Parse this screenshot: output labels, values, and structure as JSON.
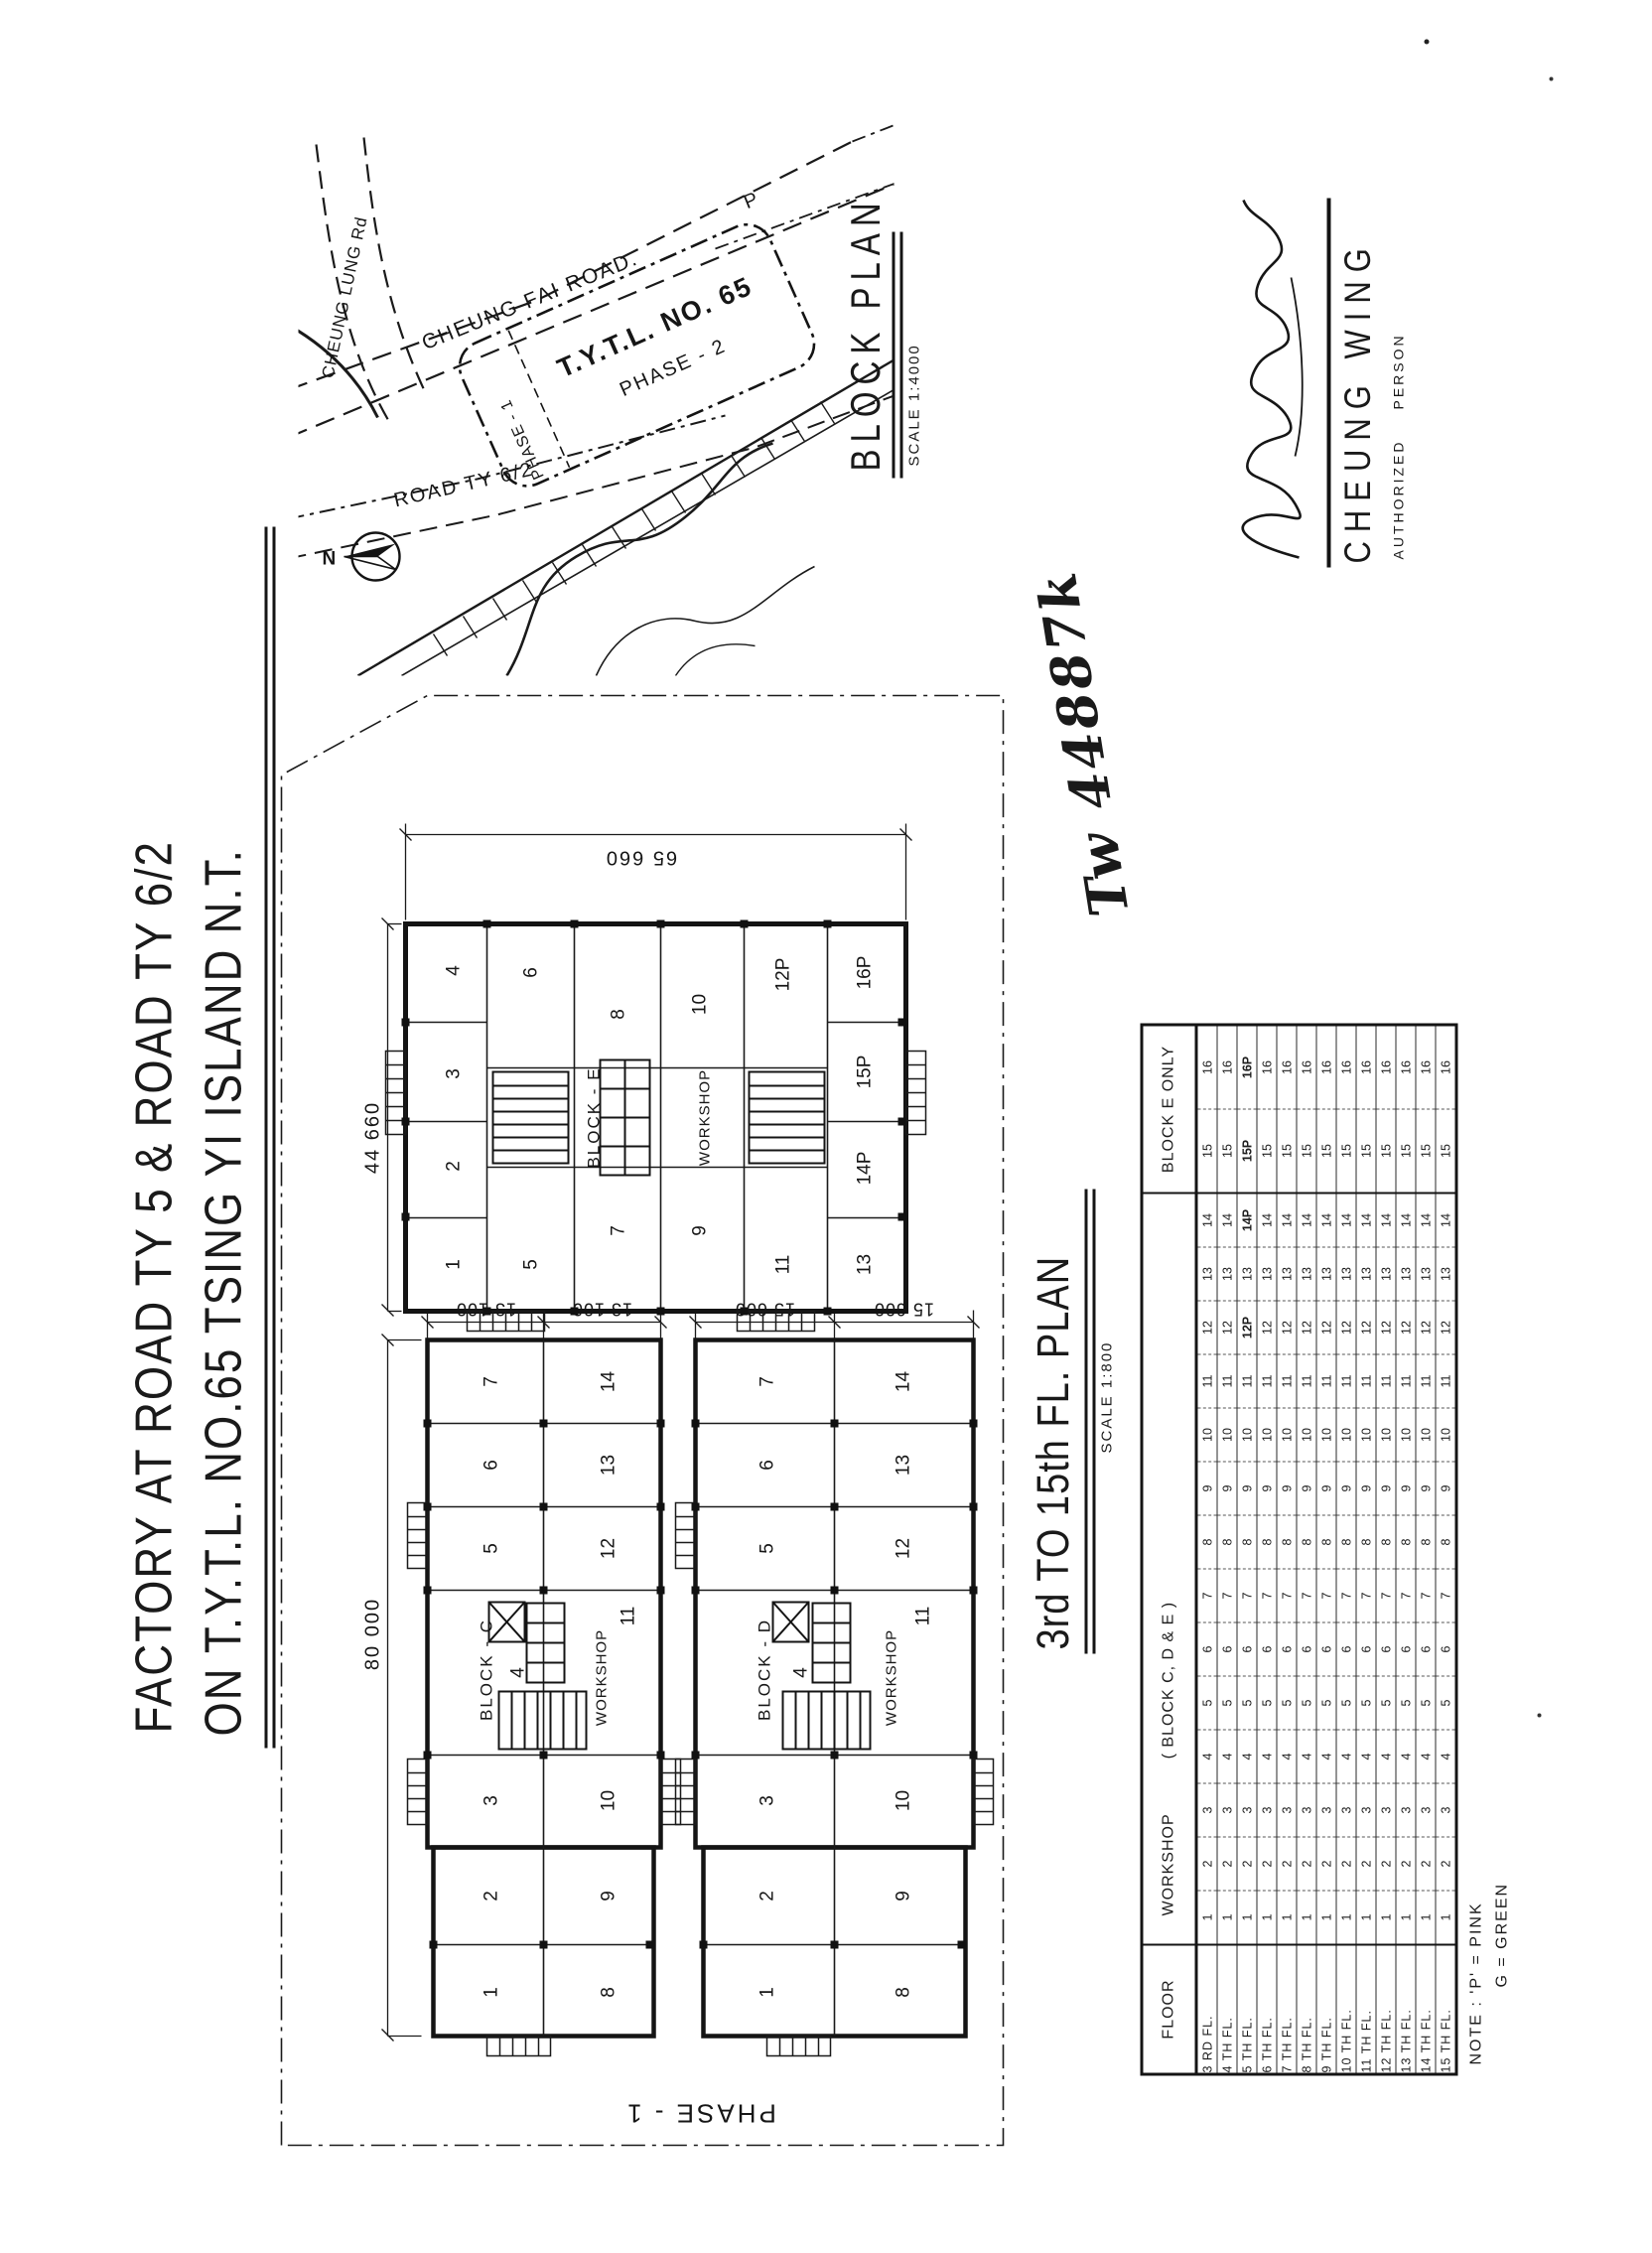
{
  "sheet": {
    "title_line1": "FACTORY AT ROAD TY 5 & ROAD TY 6/2",
    "title_line2": "ON T.Y.T.L. NO.65 TSING YI ISLAND N.T.",
    "phase_label": "PHASE - 1",
    "drawing_ref": "Tw 44887k"
  },
  "block_plan": {
    "heading": "BLOCK PLAN",
    "scale": "SCALE 1:4000",
    "north": "N",
    "road_cheung_fai": "CHEUNG FAI ROAD.",
    "road_cheung_lung": "CHEUNG LUNG Rd",
    "road_ty62": "ROAD TY 6/2",
    "lot": "T.Y.T.L. NO. 65",
    "phase2": "PHASE - 2",
    "phase1": "PHASE - 1",
    "parking": "P"
  },
  "floor_plan": {
    "heading": "3rd TO 15th FL. PLAN",
    "scale": "SCALE 1:800",
    "dims": {
      "e_width": "44 660",
      "e_height": "65 660",
      "cd_width": "80 000",
      "c_bay1": "13 100",
      "c_bay2": "13 100",
      "d_bay1": "15 600",
      "d_bay2": "15 600"
    },
    "block_e": {
      "name": "BLOCK - E",
      "workshop": "WORKSHOP",
      "rooms": [
        "1",
        "2",
        "3",
        "4",
        "5",
        "6",
        "7",
        "8",
        "9",
        "10",
        "11",
        "12P",
        "13",
        "14P",
        "15P",
        "16P"
      ]
    },
    "block_c": {
      "name": "BLOCK - C",
      "workshop": "WORKSHOP",
      "rooms": [
        "1",
        "2",
        "3",
        "4",
        "5",
        "6",
        "7",
        "8",
        "9",
        "10",
        "11",
        "12",
        "13",
        "14"
      ]
    },
    "block_d": {
      "name": "BLOCK - D",
      "workshop": "WORKSHOP",
      "rooms": [
        "1",
        "2",
        "3",
        "4",
        "5",
        "6",
        "7",
        "8",
        "9",
        "10",
        "11",
        "12",
        "13",
        "14"
      ]
    }
  },
  "schedule": {
    "header_floor": "FLOOR",
    "header_workshop": "WORKSHOP",
    "header_workshop_blocks": "( BLOCK C, D & E )",
    "header_block_e": "BLOCK E ONLY",
    "floors": [
      "3 RD FL.",
      "4 TH FL.",
      "5 TH FL.",
      "6 TH FL.",
      "7 TH FL.",
      "8 TH FL.",
      "9 TH FL.",
      "10 TH FL.",
      "11 TH FL.",
      "12 TH FL.",
      "13 TH FL.",
      "14 TH FL.",
      "15 TH FL."
    ],
    "rows": [
      [
        "1",
        "2",
        "3",
        "4",
        "5",
        "6",
        "7",
        "8",
        "9",
        "10",
        "11",
        "12",
        "13",
        "14",
        "15",
        "16"
      ],
      [
        "1",
        "2",
        "3",
        "4",
        "5",
        "6",
        "7",
        "8",
        "9",
        "10",
        "11",
        "12",
        "13",
        "14",
        "15",
        "16"
      ],
      [
        "1",
        "2",
        "3",
        "4",
        "5",
        "6",
        "7",
        "8",
        "9",
        "10",
        "11",
        "12P",
        "13",
        "14P",
        "15P",
        "16P"
      ],
      [
        "1",
        "2",
        "3",
        "4",
        "5",
        "6",
        "7",
        "8",
        "9",
        "10",
        "11",
        "12",
        "13",
        "14",
        "15",
        "16"
      ],
      [
        "1",
        "2",
        "3",
        "4",
        "5",
        "6",
        "7",
        "8",
        "9",
        "10",
        "11",
        "12",
        "13",
        "14",
        "15",
        "16"
      ],
      [
        "1",
        "2",
        "3",
        "4",
        "5",
        "6",
        "7",
        "8",
        "9",
        "10",
        "11",
        "12",
        "13",
        "14",
        "15",
        "16"
      ],
      [
        "1",
        "2",
        "3",
        "4",
        "5",
        "6",
        "7",
        "8",
        "9",
        "10",
        "11",
        "12",
        "13",
        "14",
        "15",
        "16"
      ],
      [
        "1",
        "2",
        "3",
        "4",
        "5",
        "6",
        "7",
        "8",
        "9",
        "10",
        "11",
        "12",
        "13",
        "14",
        "15",
        "16"
      ],
      [
        "1",
        "2",
        "3",
        "4",
        "5",
        "6",
        "7",
        "8",
        "9",
        "10",
        "11",
        "12",
        "13",
        "14",
        "15",
        "16"
      ],
      [
        "1",
        "2",
        "3",
        "4",
        "5",
        "6",
        "7",
        "8",
        "9",
        "10",
        "11",
        "12",
        "13",
        "14",
        "15",
        "16"
      ],
      [
        "1",
        "2",
        "3",
        "4",
        "5",
        "6",
        "7",
        "8",
        "9",
        "10",
        "11",
        "12",
        "13",
        "14",
        "15",
        "16"
      ],
      [
        "1",
        "2",
        "3",
        "4",
        "5",
        "6",
        "7",
        "8",
        "9",
        "10",
        "11",
        "12",
        "13",
        "14",
        "15",
        "16"
      ],
      [
        "1",
        "2",
        "3",
        "4",
        "5",
        "6",
        "7",
        "8",
        "9",
        "10",
        "11",
        "12",
        "13",
        "14",
        "15",
        "16"
      ]
    ],
    "note1": "NOTE :  'P' = PINK",
    "note2": "G = GREEN"
  },
  "signature": {
    "name": "CHEUNG WING",
    "role_left": "AUTHORIZED",
    "role_right": "PERSON"
  }
}
